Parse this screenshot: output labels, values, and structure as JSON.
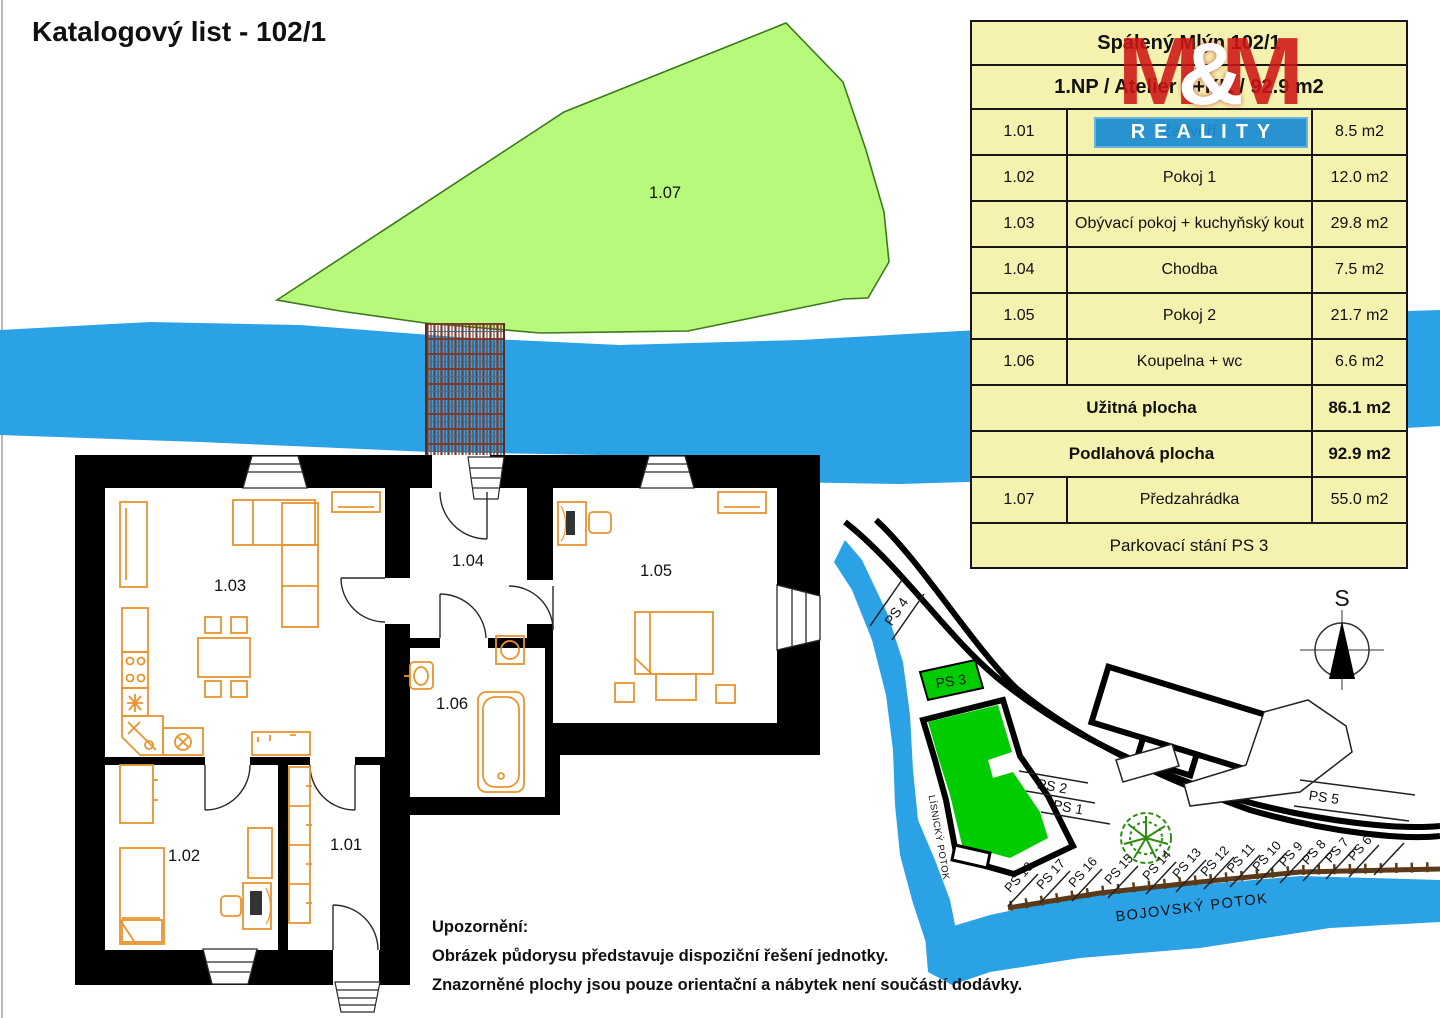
{
  "page": {
    "title": "Katalogový list - 102/1"
  },
  "logo": {
    "m_left": "M",
    "amp": "&",
    "m_right": "M",
    "reality": "REALITY"
  },
  "unit_table": {
    "title": "Spálený Mlýn 102/1",
    "subtitle": "1.NP / Atelier 3+KK / 92.9 m2",
    "rooms": [
      {
        "no": "1.01",
        "name": "Zádveří",
        "area": "8.5 m2"
      },
      {
        "no": "1.02",
        "name": "Pokoj 1",
        "area": "12.0 m2"
      },
      {
        "no": "1.03",
        "name": "Obývací pokoj + kuchyňský kout",
        "area": "29.8 m2"
      },
      {
        "no": "1.04",
        "name": "Chodba",
        "area": "7.5 m2"
      },
      {
        "no": "1.05",
        "name": "Pokoj 2",
        "area": "21.7 m2"
      },
      {
        "no": "1.06",
        "name": "Koupelna + wc",
        "area": "6.6 m2"
      }
    ],
    "totals": [
      {
        "label": "Užitná plocha",
        "value": "86.1 m2"
      },
      {
        "label": "Podlahová plocha",
        "value": "92.9 m2"
      }
    ],
    "garden_row": {
      "no": "1.07",
      "name": "Předzahrádka",
      "area": "55.0 m2"
    },
    "footer": "Parkovací stání PS 3"
  },
  "floor_plan": {
    "labels": {
      "r101": "1.01",
      "r102": "1.02",
      "r103": "1.03",
      "r104": "1.04",
      "r105": "1.05",
      "r106": "1.06",
      "garden": "1.07"
    }
  },
  "site_plan": {
    "compass": "S",
    "stream_left": "LÍSNICKÝ POTOK",
    "stream_bottom": "BOJOVSKÝ POTOK",
    "ps_road": "PS 4",
    "ps_highlight": "PS 3",
    "ps_near": [
      "PS 2",
      "PS 1"
    ],
    "ps_right": "PS 5",
    "ps_row": [
      "PS 18",
      "PS 17",
      "PS 16",
      "PS 15",
      "PS 14",
      "PS 13",
      "PS 12",
      "PS 11",
      "PS 10",
      "PS 9",
      "PS 8",
      "PS 7",
      "PS 6"
    ]
  },
  "notes": {
    "heading": "Upozornění:",
    "lines": [
      "Obrázek půdorysu představuje dispoziční řešení jednotky.",
      "Znazorněné plochy jsou pouze orientační a nábytek není součástí dodávky."
    ]
  },
  "colors": {
    "water": "#2ba1e6",
    "garden": "#b6f97b",
    "garden_border": "#3c7a1c",
    "highlight_green": "#00cc00",
    "table_bg": "#f5f1af",
    "logo_red": "#ce1616",
    "logo_blue": "#198cd2",
    "furniture": "#e8942f",
    "fence": "#5b3a19",
    "tree": "#2f8b12"
  }
}
